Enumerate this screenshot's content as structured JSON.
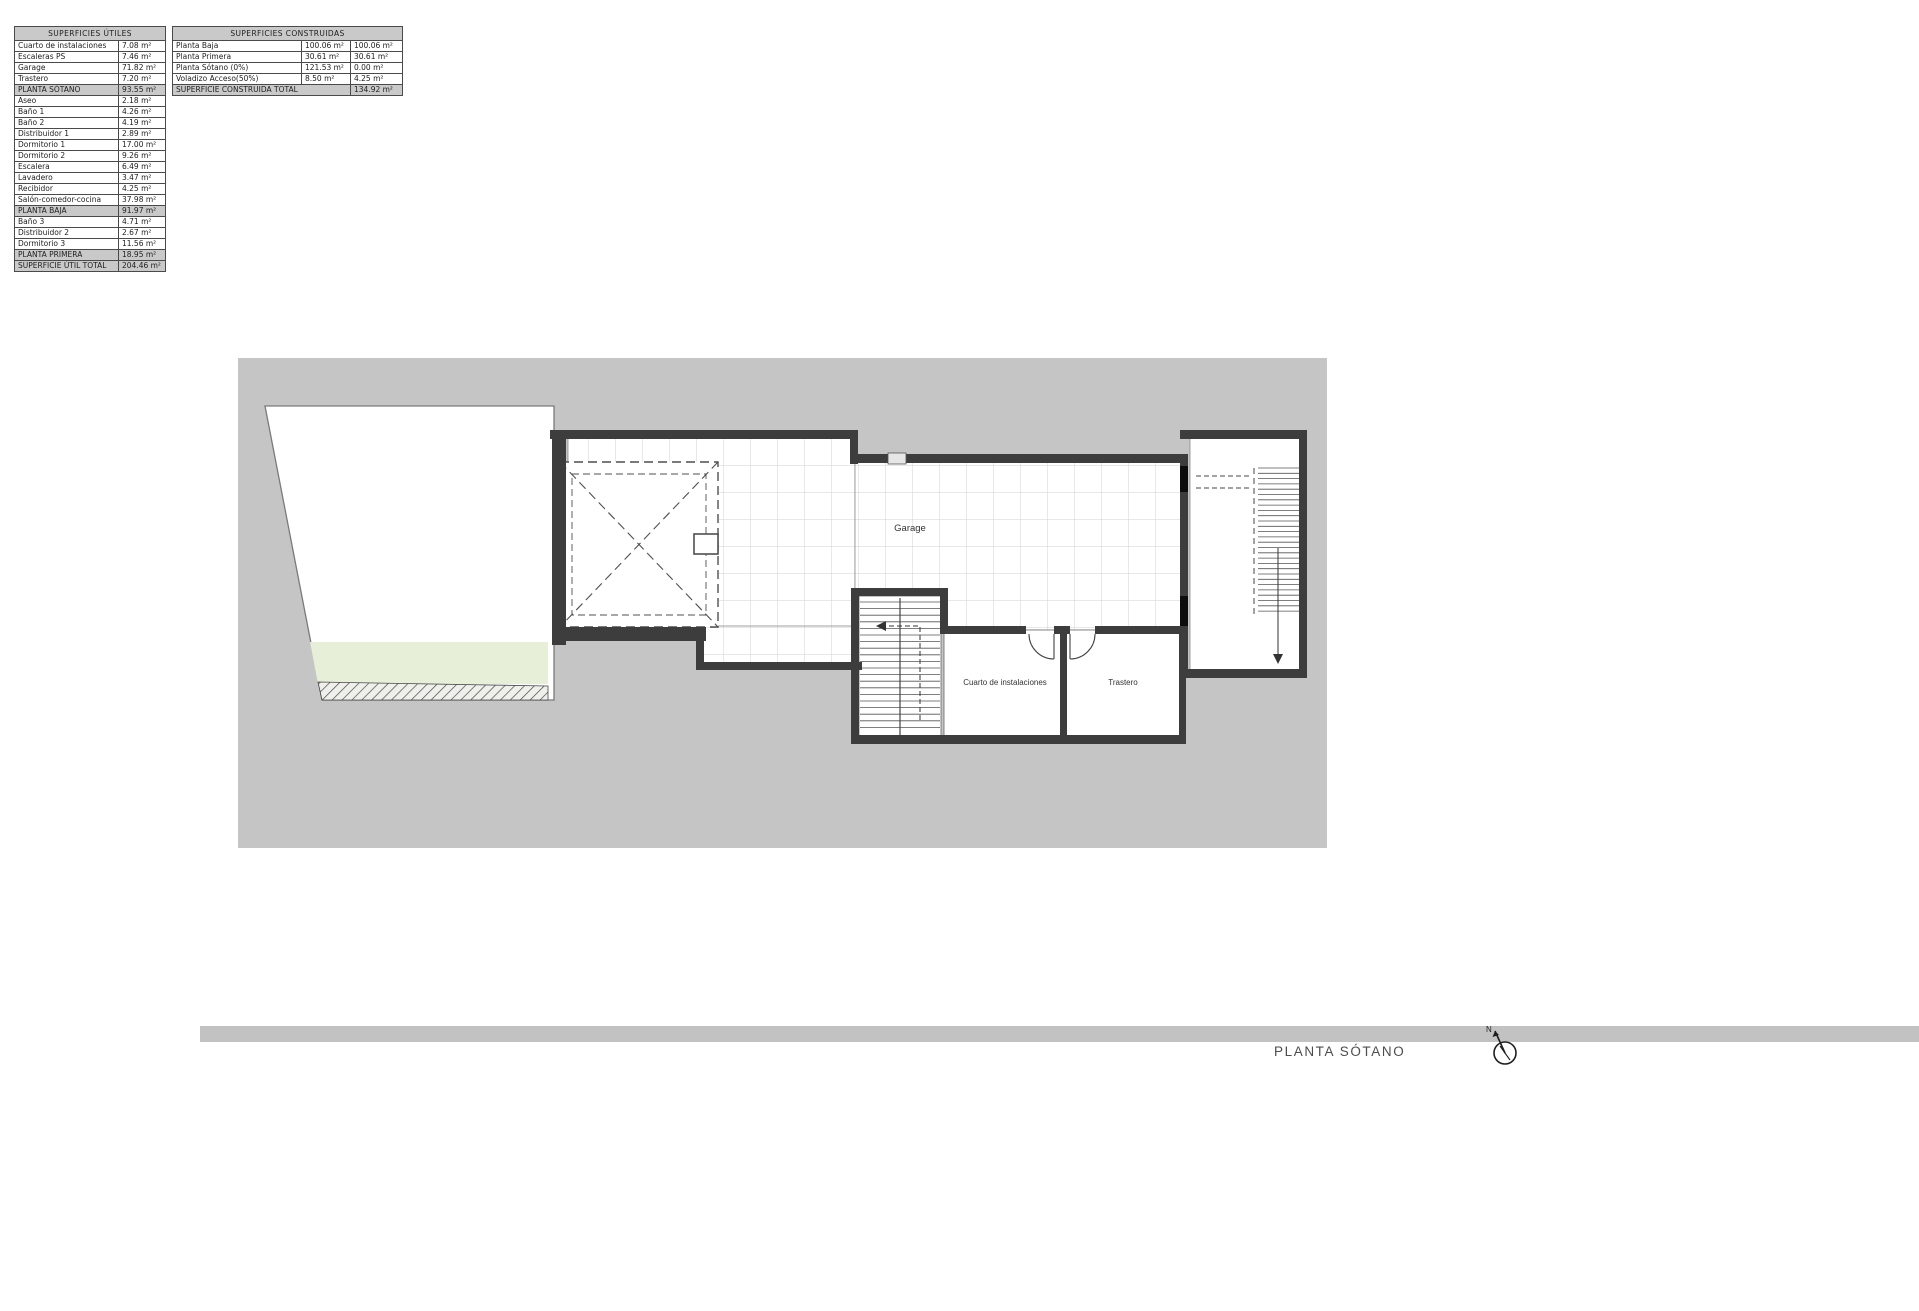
{
  "t1": {
    "title": "SUPERFICIES ÚTILES",
    "rows": [
      {
        "label": "Cuarto de instalaciones",
        "value": "7.08 m²",
        "type": "row"
      },
      {
        "label": "Escaleras PS",
        "value": "7.46 m²",
        "type": "row"
      },
      {
        "label": "Garage",
        "value": "71.82 m²",
        "type": "row"
      },
      {
        "label": "Trastero",
        "value": "7.20 m²",
        "type": "row"
      },
      {
        "label": "PLANTA SÓTANO",
        "value": "93.55 m²",
        "type": "sub"
      },
      {
        "label": "Aseo",
        "value": "2.18 m²",
        "type": "row"
      },
      {
        "label": "Baño 1",
        "value": "4.26 m²",
        "type": "row"
      },
      {
        "label": "Baño 2",
        "value": "4.19 m²",
        "type": "row"
      },
      {
        "label": "Distribuidor 1",
        "value": "2.89 m²",
        "type": "row"
      },
      {
        "label": "Dormitorio 1",
        "value": "17.00 m²",
        "type": "row"
      },
      {
        "label": "Dormitorio 2",
        "value": "9.26 m²",
        "type": "row"
      },
      {
        "label": "Escalera",
        "value": "6.49 m²",
        "type": "row"
      },
      {
        "label": "Lavadero",
        "value": "3.47 m²",
        "type": "row"
      },
      {
        "label": "Recibidor",
        "value": "4.25 m²",
        "type": "row"
      },
      {
        "label": "Salón-comedor-cocina",
        "value": "37.98 m²",
        "type": "row"
      },
      {
        "label": "PLANTA BAJA",
        "value": "91.97 m²",
        "type": "sub"
      },
      {
        "label": "Baño 3",
        "value": "4.71 m²",
        "type": "row"
      },
      {
        "label": "Distribuidor 2",
        "value": "2.67 m²",
        "type": "row"
      },
      {
        "label": "Dormitorio 3",
        "value": "11.56 m²",
        "type": "row"
      },
      {
        "label": "PLANTA PRIMERA",
        "value": "18.95 m²",
        "type": "sub"
      },
      {
        "label": "SUPERFICIE ÚTIL TOTAL",
        "value": "204.46 m²",
        "type": "total"
      }
    ]
  },
  "t2": {
    "title": "SUPERFICIES CONSTRUIDAS",
    "rows": [
      {
        "label": "Planta Baja",
        "v1": "100.06 m²",
        "v2": "100.06 m²"
      },
      {
        "label": "Planta Primera",
        "v1": "30.61 m²",
        "v2": "30.61 m²"
      },
      {
        "label": "Planta Sótano (0%)",
        "v1": "121.53 m²",
        "v2": "0.00 m²"
      },
      {
        "label": "Voladizo Acceso(50%)",
        "v1": "8.50 m²",
        "v2": "4.25 m²"
      }
    ],
    "total_label": "SUPERFICIE CONSTRUIDA TOTAL",
    "total_value": "134.92 m²"
  },
  "plan": {
    "garage": "Garage",
    "cuarto": "Cuarto de instalaciones",
    "trastero": "Trastero",
    "colors": {
      "backdrop": "#c5c5c5",
      "wall": "#3d3d3d",
      "tile_line": "#d2d2d2",
      "green": "#e7efd9",
      "band": "#c2c2c2"
    }
  },
  "footer": {
    "title": "PLANTA SÓTANO"
  },
  "icons": {
    "compass": "north-arrow"
  }
}
